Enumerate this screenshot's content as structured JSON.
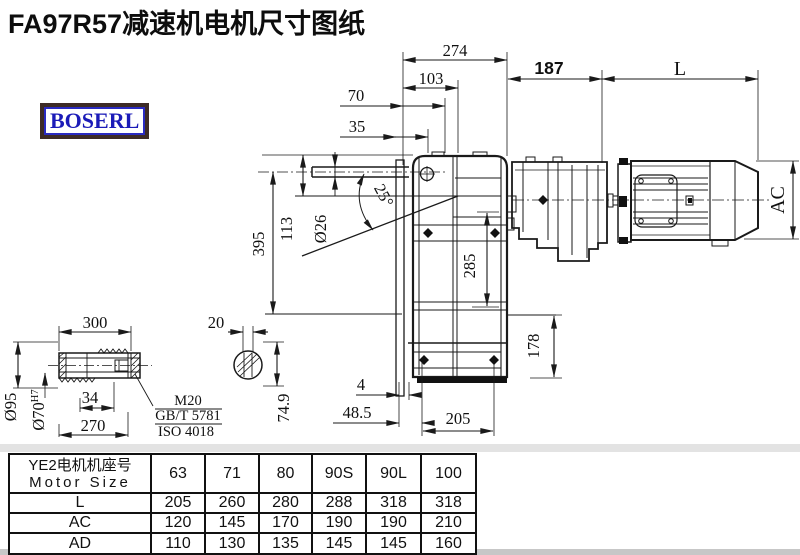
{
  "title": "FA97R57减速机电机尺寸图纸",
  "logo": "BOSERL",
  "colors": {
    "line": "#1a1a1a",
    "logo_text": "#1b1bb8",
    "logo_border": "#3d2b26"
  },
  "drawing": {
    "dims": {
      "d274": "274",
      "d103": "103",
      "d70": "70",
      "d35": "35",
      "d187": "187",
      "L": "L",
      "AC": "AC",
      "d395": "395",
      "d113": "113",
      "d26": "Ø26",
      "angle": "25°",
      "d285": "285",
      "d178": "178",
      "d4": "4",
      "d48_5": "48.5",
      "d205": "205",
      "d300": "300",
      "d95": "Ø95",
      "d70h7": "Ø70",
      "d70h7_tol": "H7",
      "d34": "34",
      "d270": "270",
      "m20": "M20",
      "gb": "GB/T 5781",
      "iso": "ISO 4018",
      "d20": "20",
      "d74_9": "74.9"
    }
  },
  "table": {
    "header_cn": "YE2电机机座号",
    "header_en": "Motor Size",
    "columns": [
      "63",
      "71",
      "80",
      "90S",
      "90L",
      "100"
    ],
    "rows": [
      {
        "label": "L",
        "values": [
          "205",
          "260",
          "280",
          "288",
          "318",
          "318"
        ]
      },
      {
        "label": "AC",
        "values": [
          "120",
          "145",
          "170",
          "190",
          "190",
          "210"
        ]
      },
      {
        "label": "AD",
        "values": [
          "110",
          "130",
          "135",
          "145",
          "145",
          "160"
        ]
      }
    ]
  }
}
